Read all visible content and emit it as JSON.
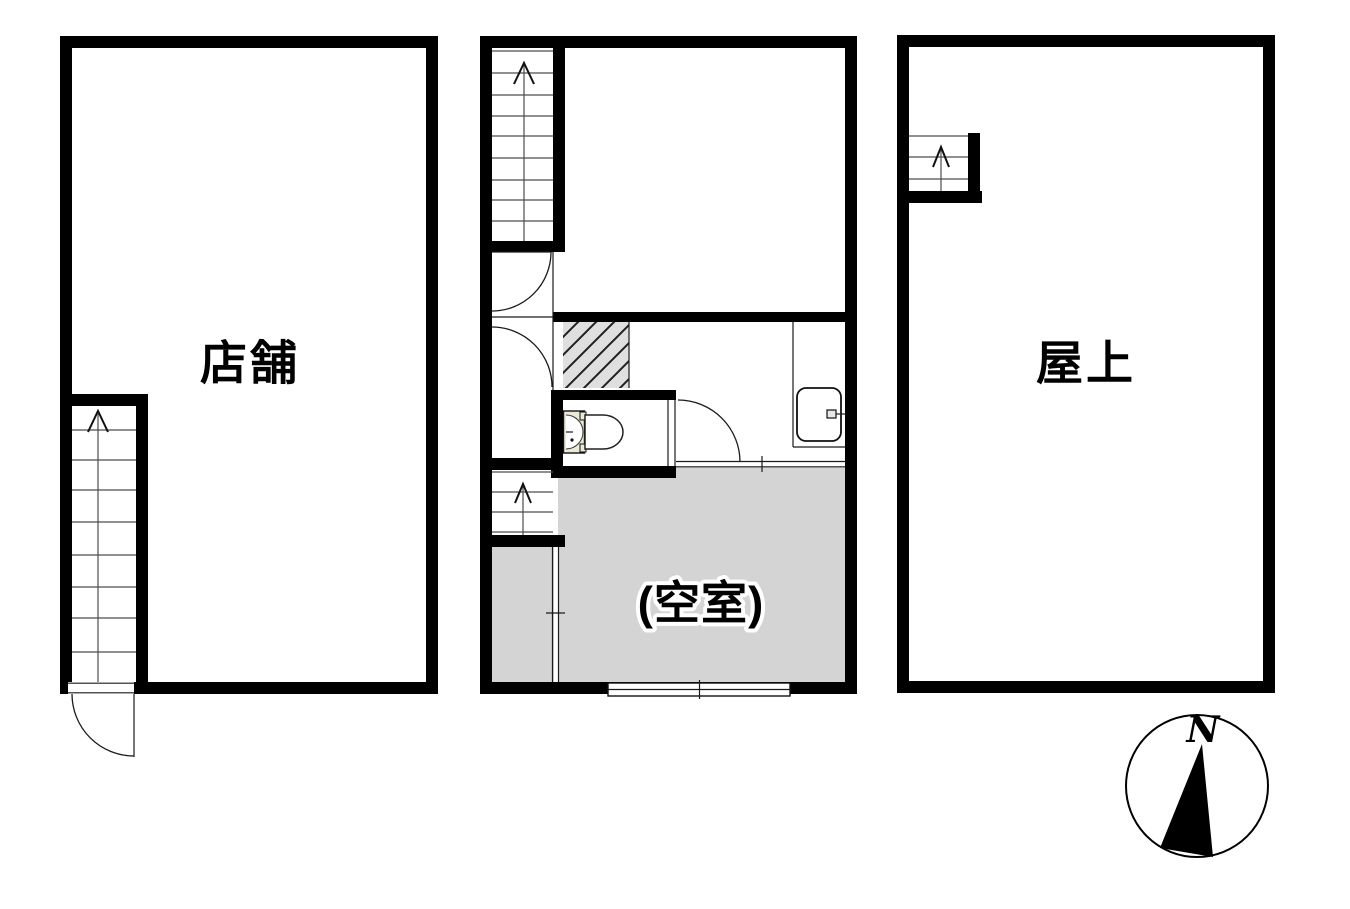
{
  "title": "building floor plan",
  "colors": {
    "wall": "#000000",
    "background": "#ffffff",
    "vacant_room_fill": "#d4d4d4",
    "entry_fill": "#d4d4d4",
    "hatch_fill": "#dfdfdf",
    "hatch_line": "#1f1f1f",
    "toilet_tank_fill": "#ece9d8",
    "line": "#1a1a1a"
  },
  "units": {
    "first_floor": {
      "label": "店舗"
    },
    "second_floor": {
      "vacant_label": "(空室)"
    },
    "roof": {
      "label": "屋上"
    }
  },
  "compass": {
    "north_label": "N"
  }
}
